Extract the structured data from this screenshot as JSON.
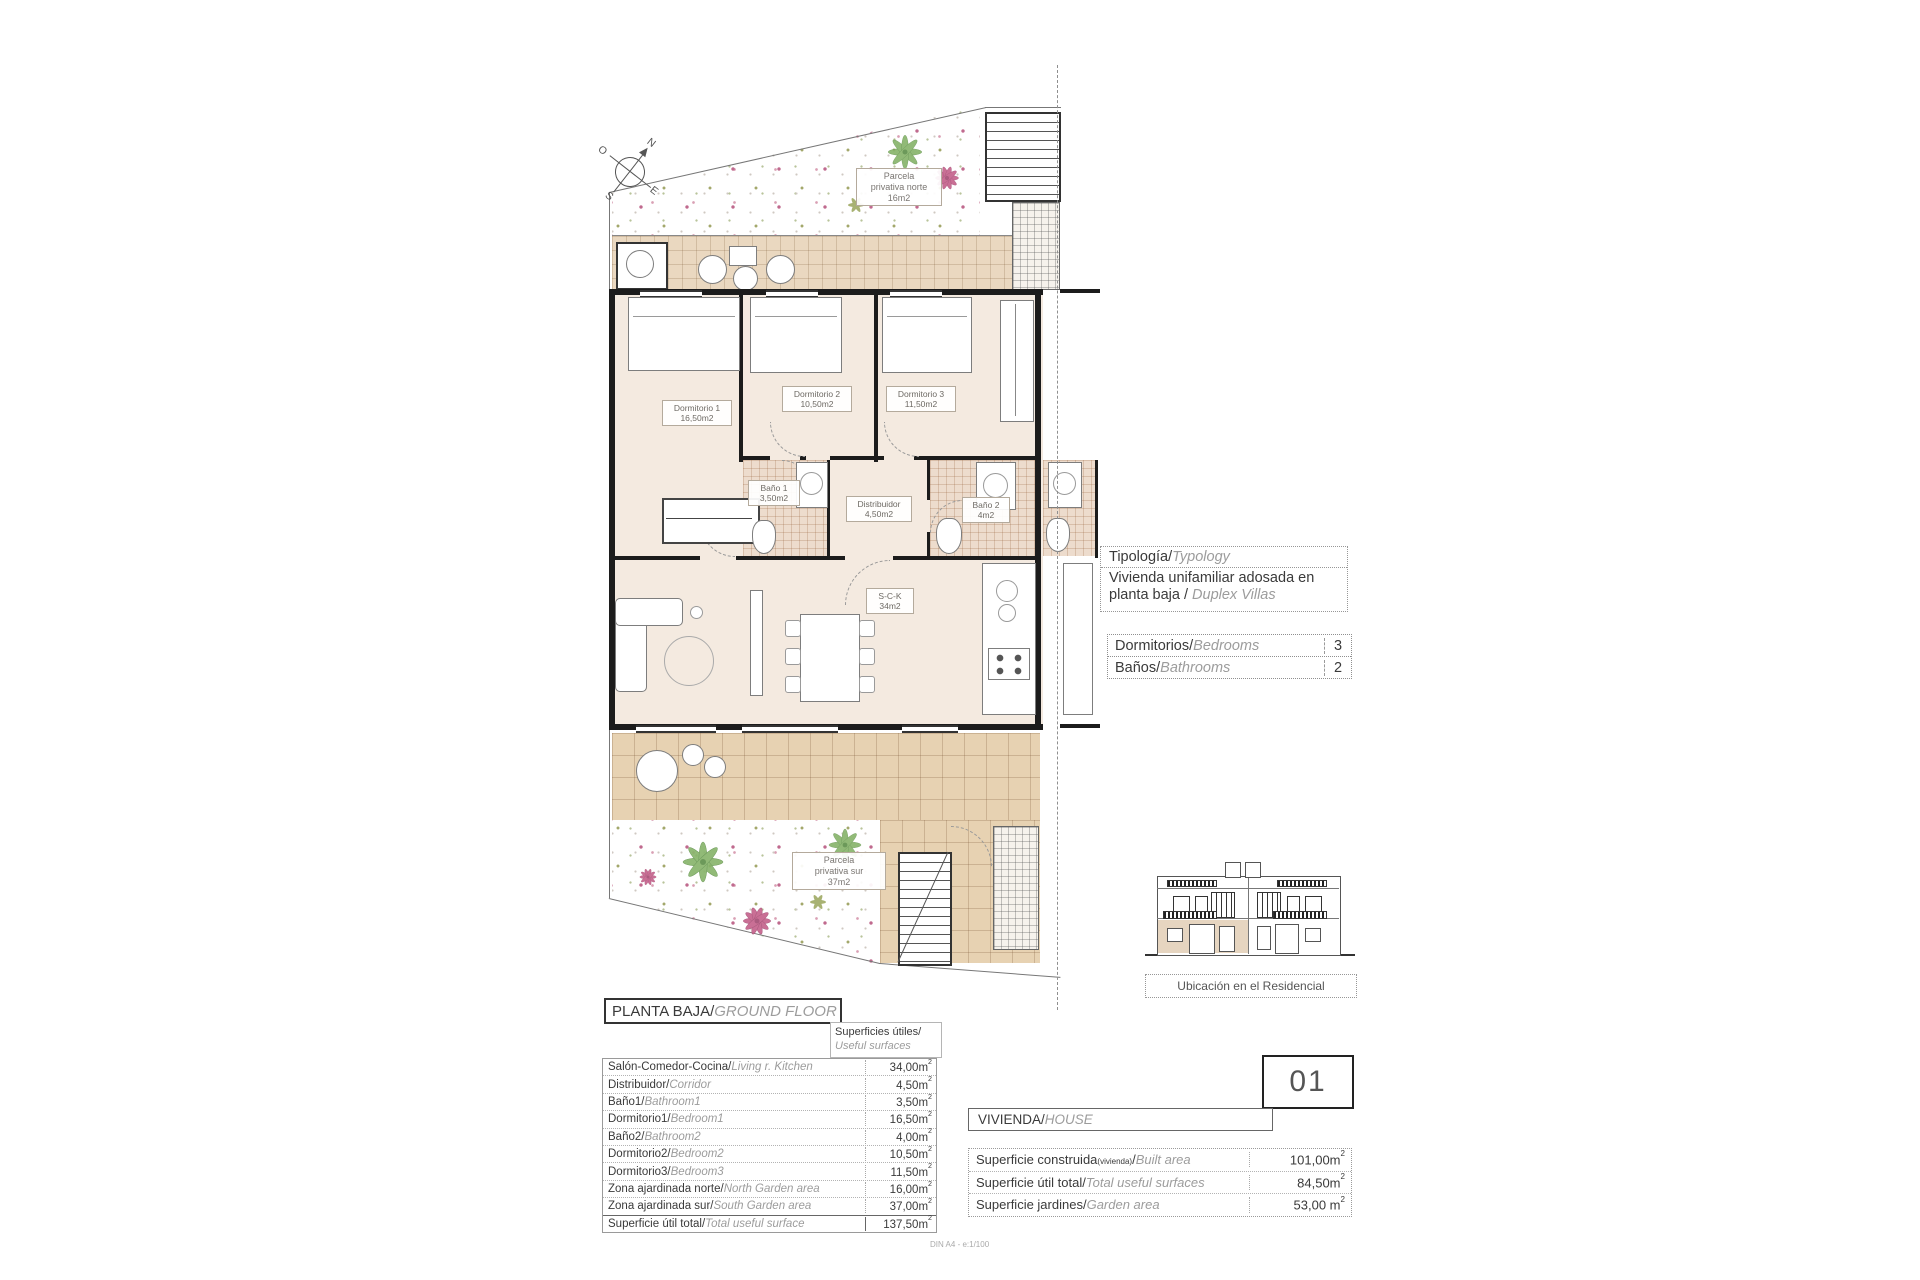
{
  "page": {
    "scale_note": "DIN A4 - e:1/100"
  },
  "compass": {
    "n": "N",
    "e": "E",
    "s": "S",
    "o": "O"
  },
  "plan_labels": {
    "parcela_norte": {
      "line1": "Parcela",
      "line2": "privativa norte",
      "line3": "16m2"
    },
    "parcela_sur": {
      "line1": "Parcela",
      "line2": "privativa sur",
      "line3": "37m2"
    },
    "dormitorio1": {
      "name": "Dormitorio 1",
      "area": "16,50m2"
    },
    "dormitorio2": {
      "name": "Dormitorio 2",
      "area": "10,50m2"
    },
    "dormitorio3": {
      "name": "Dormitorio 3",
      "area": "11,50m2"
    },
    "bano1": {
      "name": "Baño 1",
      "area": "3,50m2"
    },
    "bano2": {
      "name": "Baño 2",
      "area": "4m2"
    },
    "distribuidor": {
      "name": "Distribuidor",
      "area": "4,50m2"
    },
    "sck": {
      "name": "S-C-K",
      "area": "34m2"
    }
  },
  "typology_box": {
    "header_es": "Tipología/",
    "header_en": "Typology",
    "body_es": "Vivienda unifamiliar adosada en planta baja / ",
    "body_en": "Duplex Villas"
  },
  "counts_table": {
    "rows": [
      {
        "label_es": "Dormitorios/",
        "label_en": "Bedrooms",
        "value": "3"
      },
      {
        "label_es": "Baños/",
        "label_en": "Bathrooms",
        "value": "2"
      }
    ]
  },
  "elevation": {
    "caption": "Ubicación en el Residencial"
  },
  "floor_header": {
    "title_es": "PLANTA BAJA/",
    "title_en": "GROUND FLOOR",
    "sub_es": "Superficies útiles/",
    "sub_en": "Useful surfaces"
  },
  "useful_surfaces": {
    "rows": [
      {
        "es": "Salón-Comedor-Cocina/",
        "en": "Living r. Kitchen",
        "value": "34,00m",
        "sup": "2"
      },
      {
        "es": "Distribuidor/",
        "en": "Corridor",
        "value": "4,50m",
        "sup": "2"
      },
      {
        "es": "Baño1/",
        "en": "Bathroom1",
        "value": "3,50m",
        "sup": "2"
      },
      {
        "es": "Dormitorio1/",
        "en": "Bedroom1",
        "value": "16,50m",
        "sup": "2"
      },
      {
        "es": "Baño2/",
        "en": "Bathroom2",
        "value": "4,00m",
        "sup": "2"
      },
      {
        "es": "Dormitorio2/",
        "en": "Bedroom2",
        "value": "10,50m",
        "sup": "2"
      },
      {
        "es": "Dormitorio3/",
        "en": "Bedroom3",
        "value": "11,50m",
        "sup": "2"
      },
      {
        "es": "Zona ajardinada norte/",
        "en": "North Garden area",
        "value": "16,00m",
        "sup": "2"
      },
      {
        "es": "Zona ajardinada sur/",
        "en": "South Garden area",
        "value": "37,00m",
        "sup": "2"
      },
      {
        "es": "Superficie útil total/",
        "en": "Total useful surface",
        "value": "137,50m",
        "sup": "2"
      }
    ]
  },
  "house_box": {
    "number": "01",
    "label_es": "VIVIENDA/",
    "label_en": "HOUSE"
  },
  "house_surfaces": {
    "rows": [
      {
        "es": "Superficie construida",
        "es_small": "(vivienda)",
        "slash": "/",
        "en": "Built area",
        "value": "101,00m",
        "sup": "2"
      },
      {
        "es": "Superficie útil total",
        "es_small": "",
        "slash": "/",
        "en": "Total useful surfaces",
        "value": "84,50m",
        "sup": "2"
      },
      {
        "es": "Superficie jardines",
        "es_small": "",
        "slash": "/",
        "en": "Garden area",
        "value": "53,00 m",
        "sup": "2"
      }
    ]
  }
}
